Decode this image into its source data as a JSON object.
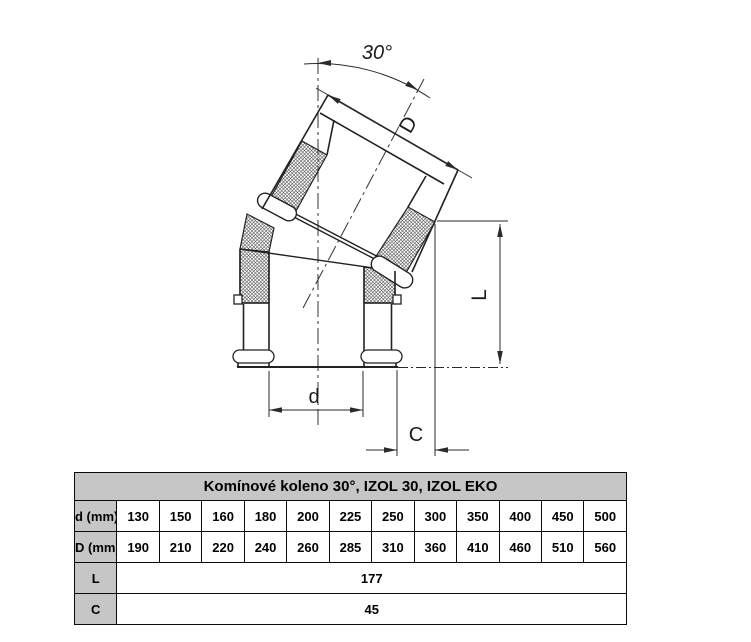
{
  "drawing": {
    "angle_label": "30°",
    "dim_outer_diameter": "D",
    "dim_length": "L",
    "dim_inner_diameter": "d",
    "dim_offset": "C"
  },
  "table": {
    "title": "Komínové koleno 30°, IZOL 30, IZOL EKO",
    "rows": [
      {
        "label": "d (mm) vnitřní průměr:",
        "values": [
          "130",
          "150",
          "160",
          "180",
          "200",
          "225",
          "250",
          "300",
          "350",
          "400",
          "450",
          "500"
        ]
      },
      {
        "label": "D (mm) vnější průměr:",
        "values": [
          "190",
          "210",
          "220",
          "240",
          "260",
          "285",
          "310",
          "360",
          "410",
          "460",
          "510",
          "560"
        ]
      },
      {
        "label": "L",
        "value": "177"
      },
      {
        "label": "C",
        "value": "45"
      }
    ]
  }
}
